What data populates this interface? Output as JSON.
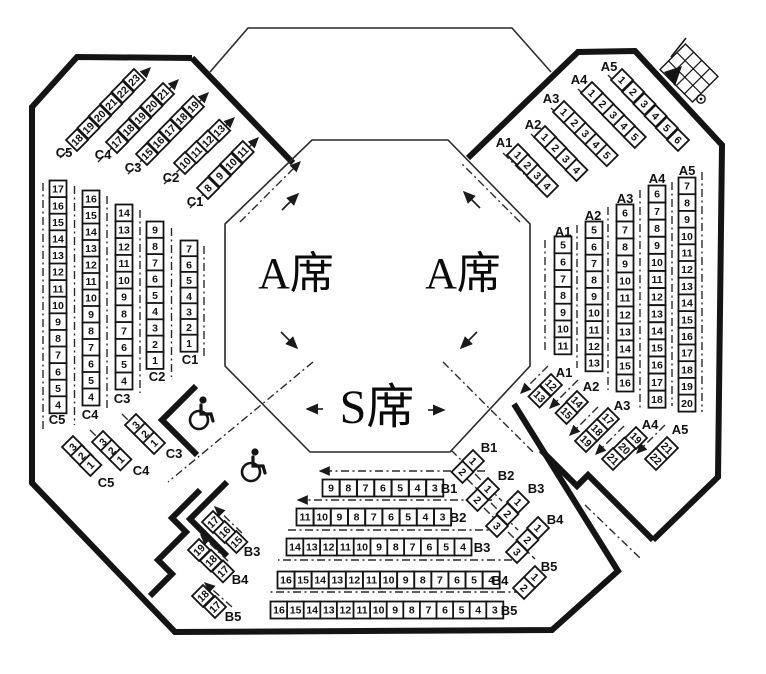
{
  "texts": {
    "a_seat_left": "A席",
    "a_seat_right": "A席",
    "s_seat": "S席"
  },
  "colors": {
    "line": "#141414",
    "background": "#ffffff"
  },
  "icons": {
    "wheelchair": "wheelchair-icon",
    "stairs": "stairs-icon",
    "flow_arrows": "direction-arrow"
  },
  "seat_groups": [
    {
      "id": "c5t",
      "label": "C5",
      "seats": [
        "18",
        "19",
        "20",
        "21",
        "22",
        "23"
      ]
    },
    {
      "id": "c4t",
      "label": "C4",
      "seats": [
        "17",
        "18",
        "19",
        "20",
        "21"
      ]
    },
    {
      "id": "c3t",
      "label": "C3",
      "seats": [
        "15",
        "16",
        "17",
        "18",
        "19"
      ]
    },
    {
      "id": "c2t",
      "label": "C2",
      "seats": [
        "10",
        "11",
        "12",
        "13"
      ]
    },
    {
      "id": "c1t",
      "label": "C1",
      "seats": [
        "8",
        "9",
        "10",
        "11"
      ]
    },
    {
      "id": "c5c",
      "label": "C5",
      "seats": [
        "17",
        "16",
        "15",
        "14",
        "13",
        "12",
        "11",
        "10",
        "9",
        "8",
        "7",
        "6",
        "5",
        "4"
      ]
    },
    {
      "id": "c4c",
      "label": "C4",
      "seats": [
        "16",
        "15",
        "14",
        "13",
        "12",
        "11",
        "10",
        "9",
        "8",
        "7",
        "6",
        "5",
        "4"
      ]
    },
    {
      "id": "c3c",
      "label": "C3",
      "seats": [
        "14",
        "13",
        "12",
        "11",
        "10",
        "9",
        "8",
        "7",
        "6",
        "5",
        "4"
      ]
    },
    {
      "id": "c2c",
      "label": "C2",
      "seats": [
        "9",
        "8",
        "7",
        "6",
        "5",
        "4",
        "3",
        "2",
        "1"
      ]
    },
    {
      "id": "c1c",
      "label": "C1",
      "seats": [
        "7",
        "6",
        "5",
        "4",
        "3",
        "2",
        "1"
      ]
    },
    {
      "id": "c5b",
      "label": "C5",
      "seats": [
        "3",
        "2",
        "1"
      ]
    },
    {
      "id": "c4b",
      "label": "C4",
      "seats": [
        "3",
        "2",
        "1"
      ]
    },
    {
      "id": "c3b",
      "label": "C3",
      "seats": [
        "3",
        "2",
        "1"
      ]
    },
    {
      "id": "b3dl",
      "label": "B3",
      "seats": [
        "17",
        "16",
        "15"
      ]
    },
    {
      "id": "b4dl",
      "label": "B4",
      "seats": [
        "19",
        "18",
        "17"
      ]
    },
    {
      "id": "b5dl",
      "label": "B5",
      "seats": [
        "18",
        "17"
      ]
    },
    {
      "id": "b1r",
      "label": "B1",
      "seats": [
        "9",
        "8",
        "7",
        "6",
        "5",
        "4",
        "3"
      ]
    },
    {
      "id": "b2r",
      "label": "B2",
      "seats": [
        "11",
        "10",
        "9",
        "8",
        "7",
        "6",
        "5",
        "4",
        "3"
      ]
    },
    {
      "id": "b3r",
      "label": "B3",
      "seats": [
        "14",
        "13",
        "12",
        "11",
        "10",
        "9",
        "8",
        "7",
        "6",
        "5",
        "4"
      ]
    },
    {
      "id": "b4r",
      "label": "B4",
      "seats": [
        "16",
        "15",
        "14",
        "13",
        "12",
        "11",
        "10",
        "9",
        "8",
        "7",
        "6",
        "5",
        "4"
      ]
    },
    {
      "id": "b5r",
      "label": "B5",
      "seats": [
        "16",
        "15",
        "14",
        "13",
        "12",
        "11",
        "10",
        "9",
        "8",
        "7",
        "6",
        "5",
        "4",
        "3"
      ]
    },
    {
      "id": "b1dr",
      "label": "B1",
      "seats": [
        "1",
        "2"
      ]
    },
    {
      "id": "b2dr",
      "label": "B2",
      "seats": [
        "1",
        "2"
      ]
    },
    {
      "id": "b3dr",
      "label": "B3",
      "seats": [
        "1",
        "2",
        "3"
      ]
    },
    {
      "id": "b4dr",
      "label": "B4",
      "seats": [
        "1",
        "2",
        "3"
      ]
    },
    {
      "id": "b5dr",
      "label": "B5",
      "seats": [
        "1",
        "2"
      ]
    },
    {
      "id": "a1t",
      "label": "A1",
      "seats": [
        "1",
        "2",
        "3",
        "4"
      ]
    },
    {
      "id": "a2t",
      "label": "A2",
      "seats": [
        "1",
        "2",
        "3",
        "4"
      ]
    },
    {
      "id": "a3t",
      "label": "A3",
      "seats": [
        "1",
        "2",
        "3",
        "4",
        "5"
      ]
    },
    {
      "id": "a4t",
      "label": "A4",
      "seats": [
        "1",
        "2",
        "3",
        "4",
        "5"
      ]
    },
    {
      "id": "a5t",
      "label": "A5",
      "seats": [
        "1",
        "2",
        "3",
        "4",
        "5",
        "6"
      ]
    },
    {
      "id": "a1c",
      "label": "A1",
      "seats": [
        "5",
        "6",
        "7",
        "8",
        "9",
        "10",
        "11"
      ]
    },
    {
      "id": "a2c",
      "label": "A2",
      "seats": [
        "5",
        "6",
        "7",
        "8",
        "9",
        "10",
        "11",
        "12",
        "13"
      ]
    },
    {
      "id": "a3c",
      "label": "A3",
      "seats": [
        "6",
        "7",
        "8",
        "9",
        "10",
        "11",
        "12",
        "13",
        "14",
        "15",
        "16"
      ]
    },
    {
      "id": "a4c",
      "label": "A4",
      "seats": [
        "6",
        "7",
        "8",
        "9",
        "10",
        "11",
        "12",
        "13",
        "14",
        "15",
        "16",
        "17",
        "18"
      ]
    },
    {
      "id": "a5c",
      "label": "A5",
      "seats": [
        "7",
        "8",
        "9",
        "10",
        "11",
        "12",
        "13",
        "14",
        "15",
        "16",
        "17",
        "18",
        "19",
        "20"
      ]
    },
    {
      "id": "a1b",
      "label": "A1",
      "seats": [
        "12",
        "13"
      ]
    },
    {
      "id": "a2b",
      "label": "A2",
      "seats": [
        "14",
        "15"
      ]
    },
    {
      "id": "a3b",
      "label": "A3",
      "seats": [
        "17",
        "18",
        "19"
      ]
    },
    {
      "id": "a4b",
      "label": "A4",
      "seats": [
        "19",
        "20",
        "21"
      ]
    },
    {
      "id": "a5b",
      "label": "A5",
      "seats": [
        "21",
        "22"
      ]
    }
  ]
}
